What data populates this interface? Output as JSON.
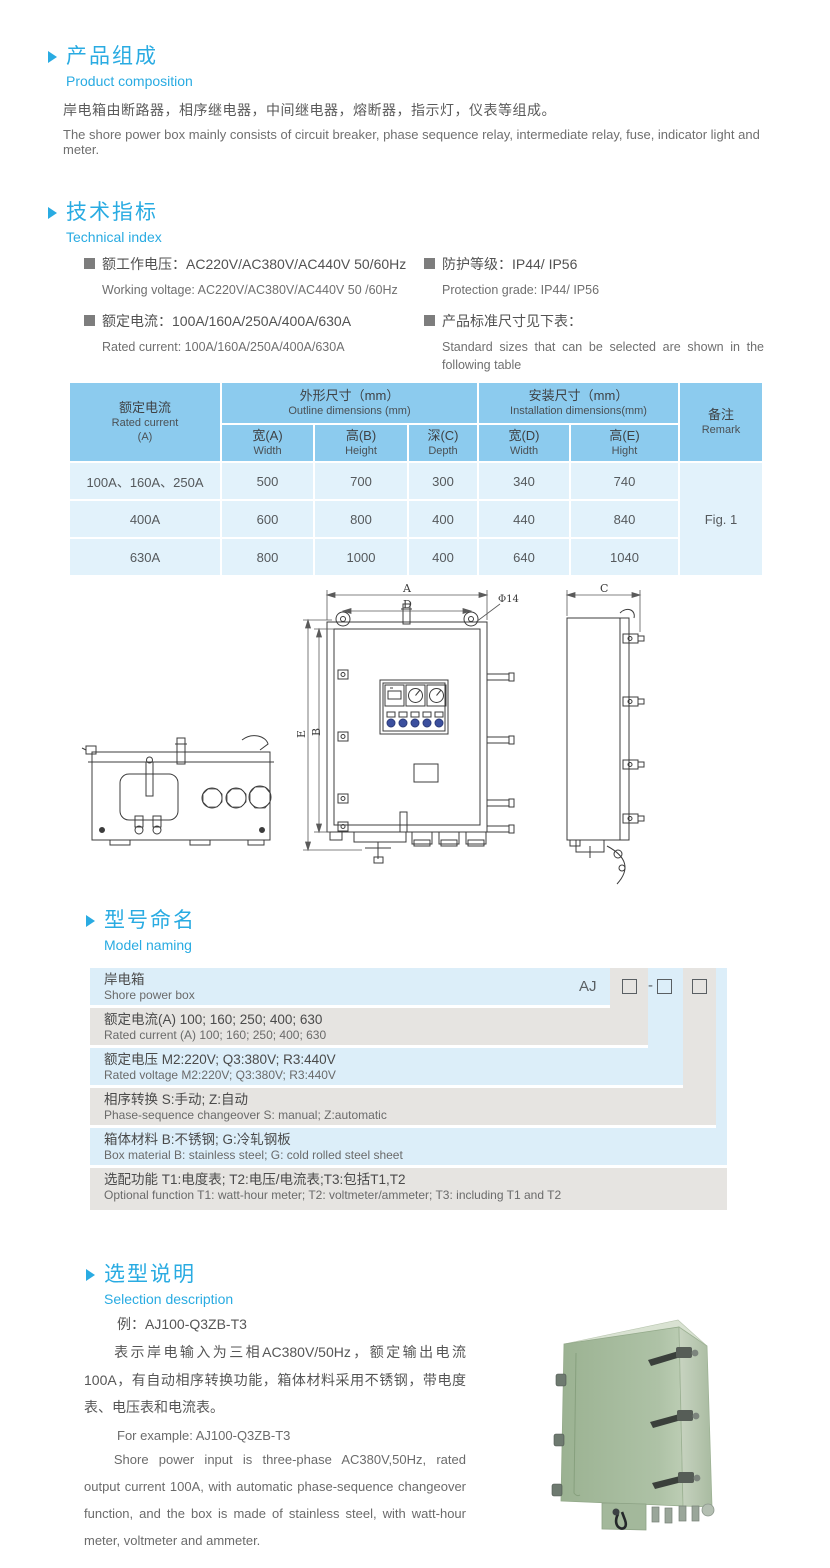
{
  "composition": {
    "title_zh": "产品组成",
    "title_en": "Product composition",
    "body_zh": "岸电箱由断路器，相序继电器，中间继电器，熔断器，指示灯，仪表等组成。",
    "body_en": "The shore power box mainly consists of circuit breaker, phase sequence relay, intermediate relay, fuse, indicator light and meter."
  },
  "technical": {
    "title_zh": "技术指标",
    "title_en": "Technical index",
    "specs": [
      {
        "zh": "额工作电压：AC220V/AC380V/AC440V  50/60Hz",
        "en": "Working voltage: AC220V/AC380V/AC440V 50 /60Hz"
      },
      {
        "zh": "额定电流：100A/160A/250A/400A/630A",
        "en": "Rated current: 100A/160A/250A/400A/630A"
      },
      {
        "zh": "防护等级：IP44/ IP56",
        "en": "Protection grade: IP44/ IP56"
      },
      {
        "zh": "产品标准尺寸见下表：",
        "en": "Standard sizes that can be selected are shown in the following table"
      }
    ]
  },
  "size_table": {
    "col_rated_zh": "额定电流",
    "col_rated_en": "Rated current",
    "col_rated_unit": "(A)",
    "group_outline_zh": "外形尺寸（mm）",
    "group_outline_en": "Outline dimensions (mm)",
    "group_install_zh": "安装尺寸（mm）",
    "group_install_en": "Installation dimensions(mm)",
    "col_remark_zh": "备注",
    "col_remark_en": "Remark",
    "subcols": [
      {
        "zh": "宽(A)",
        "en": "Width"
      },
      {
        "zh": "高(B)",
        "en": "Height"
      },
      {
        "zh": "深(C)",
        "en": "Depth"
      },
      {
        "zh": "宽(D)",
        "en": "Width"
      },
      {
        "zh": "高(E)",
        "en": "Hight"
      }
    ],
    "rows": [
      {
        "current": "100A、160A、250A",
        "w": "500",
        "h": "700",
        "d": "300",
        "iw": "340",
        "ih": "740"
      },
      {
        "current": "400A",
        "w": "600",
        "h": "800",
        "d": "400",
        "iw": "440",
        "ih": "840"
      },
      {
        "current": "630A",
        "w": "800",
        "h": "1000",
        "d": "400",
        "iw": "640",
        "ih": "1040"
      }
    ],
    "remark_value": "Fig. 1"
  },
  "drawing": {
    "dim_a": "A",
    "dim_d": "D",
    "dim_hole": "Φ14",
    "dim_e": "E",
    "dim_b": "B",
    "dim_c": "C"
  },
  "model_naming": {
    "title_zh": "型号命名",
    "title_en": "Model naming",
    "prefix": "AJ",
    "dash": "-",
    "rows": [
      {
        "zh": "岸电箱",
        "en": "Shore power box"
      },
      {
        "zh": "额定电流(A)  100; 160; 250; 400; 630",
        "en": "Rated current (A) 100; 160; 250; 400; 630"
      },
      {
        "zh": "额定电压   M2:220V;  Q3:380V;  R3:440V",
        "en": "Rated voltage  M2:220V;  Q3:380V;  R3:440V"
      },
      {
        "zh": "相序转换  S:手动; Z:自动",
        "en": "Phase-sequence changeover  S: manual;  Z:automatic"
      },
      {
        "zh": "箱体材料    B:不锈钢;  G:冷轧钢板",
        "en": "Box material    B: stainless steel; G: cold rolled steel sheet"
      },
      {
        "zh": "选配功能      T1:电度表;  T2:电压/电流表;T3:包括T1,T2",
        "en": "Optional function  T1: watt-hour meter; T2: voltmeter/ammeter; T3: including T1 and T2"
      }
    ]
  },
  "selection": {
    "title_zh": "选型说明",
    "title_en": "Selection description",
    "example_zh": "例：AJ100-Q3ZB-T3",
    "desc_zh": "表示岸电输入为三相AC380V/50Hz，额定输出电流100A，有自动相序转换功能，箱体材料采用不锈钢，带电度表、电压表和电流表。",
    "example_en": "For example: AJ100-Q3ZB-T3",
    "desc_en": "Shore power input is three-phase AC380V,50Hz, rated output current 100A, with automatic phase-sequence changeover function, and the box is made of stainless steel, with watt-hour meter, voltmeter and ammeter."
  },
  "colors": {
    "accent": "#29abe2",
    "table_header": "#8ccbee",
    "table_body": "#e2f2fb",
    "band_blue": "#dceef9",
    "band_gray": "#e6e4e1",
    "cabinet_green": "#a7bc9f"
  }
}
